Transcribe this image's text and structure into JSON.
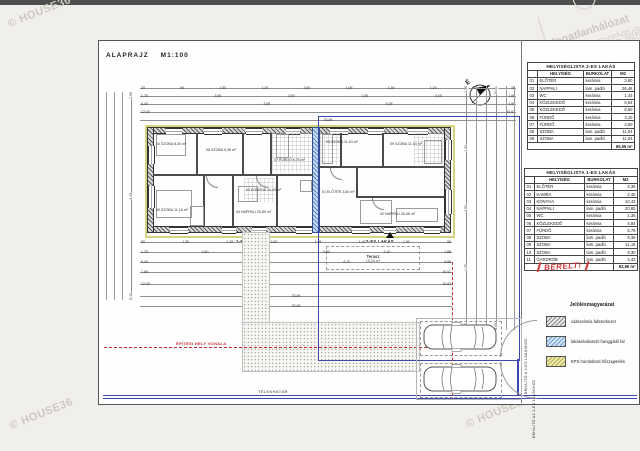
{
  "header": {
    "title": "ALAPRAJZ",
    "scale": "M1:100"
  },
  "compass": {
    "label": "É"
  },
  "watermarks": {
    "copyright": "© HOUSE36"
  },
  "logo": {
    "line1": "Ingatlanhálózat",
    "line2": "HOUSE36"
  },
  "plan": {
    "apartment1_label": "1-ES LAKÁS",
    "apartment2_label": "2-ES LAKÁS",
    "terrace_label": "Terasz",
    "terrace_area": "15,24 m²",
    "building_line_label": "ÉPÍTÉSI HELY VONALA",
    "plot_line_label": "TELEKHATÁR",
    "driveway_label_top": "BEHAJTÓ A 2-ES LAKÁSHOZ",
    "driveway_label_bottom": "BEHAJTÓ AZ 1-ES LAKÁSHOZ",
    "room_tags": [
      "10 SZOBA 8,30 m²",
      "08 SZOBA 9,36 m²",
      "07 FÜRDŐ 5,75 m²",
      "09 SZOBA 11,16 m²",
      "04 NAPPALI 20,80 m²",
      "03 KONYHA 10,43 m²",
      "08 SZOBA 11,04 m²",
      "09 SZOBA 11,04 m²",
      "02 NAPPALI 26,46 m²",
      "01 ELŐTÉR 3,60 m²"
    ],
    "dims": {
      "top": [
        [
          "30",
          "90",
          "1,50",
          "1,20",
          "2,60",
          "1,05",
          "1,50",
          "1,20",
          "90",
          "30"
        ],
        [
          "1,75",
          "3,65",
          "2,60",
          "1,05",
          "3,45",
          "1,88"
        ],
        [
          "5,40",
          "4,65",
          "6,35",
          "4,50"
        ],
        [
          "12,43",
          "10,63"
        ],
        [
          "23,06"
        ]
      ],
      "bottom": [
        [
          "90",
          "1,30",
          "1,20",
          "2,60",
          "1,05",
          "1,40",
          "1,50",
          "90"
        ],
        [
          "1,75",
          "2,60",
          "1,35",
          "4,50",
          "2,10",
          "1,88"
        ],
        [
          "5,43",
          "3,10",
          "4,70",
          "6,88"
        ],
        [
          "7,65",
          "10,01"
        ],
        [
          "12,43",
          "10,63"
        ],
        [
          "23,06"
        ],
        [
          "23,06"
        ]
      ],
      "left": [
        [
          "1,50",
          "4,43",
          "3,10"
        ]
      ],
      "right": [
        [
          "1,50",
          "1,20",
          "4,50",
          "1,05",
          "1,50"
        ],
        [
          "10,01",
          "8,05"
        ]
      ]
    }
  },
  "tables": [
    {
      "title": "HELYISÉGLISTA 2-ES LAKÁS",
      "columns": [
        "HELYISÉG",
        "BURKOLAT",
        "M2"
      ],
      "rows": [
        [
          "01",
          "ELŐTÉR",
          "kerámia",
          "3,60"
        ],
        [
          "02",
          "NAPPALI",
          "lam. padló",
          "26,46"
        ],
        [
          "03",
          "WC",
          "kerámia",
          "1,43"
        ],
        [
          "04",
          "KÖZLEKEDŐ",
          "kerámia",
          "6,64"
        ],
        [
          "05",
          "KÖZLEKEDŐ",
          "kerámia",
          "6,60"
        ],
        [
          "06",
          "FÜRDŐ",
          "kerámia",
          "3,10"
        ],
        [
          "07",
          "FÜRDŐ",
          "kerámia",
          "4,50"
        ],
        [
          "08",
          "SZOBA",
          "lam. padló",
          "11,04"
        ],
        [
          "09",
          "SZOBA",
          "lam. padló",
          "11,04"
        ]
      ],
      "total": "65,55 m²"
    },
    {
      "title": "HELYISÉGLISTA 1-ES LAKÁS",
      "columns": [
        "HELYISÉG",
        "BURKOLAT",
        "M2"
      ],
      "rows": [
        [
          "01",
          "ELŐTÉR",
          "kerámia",
          "4,36"
        ],
        [
          "02",
          "KAMRA",
          "kerámia",
          "2,40"
        ],
        [
          "03",
          "KONYHA",
          "kerámia",
          "10,43"
        ],
        [
          "04",
          "NAPPALI",
          "lam. padló",
          "20,80"
        ],
        [
          "05",
          "WC",
          "kerámia",
          "1,35"
        ],
        [
          "06",
          "KÖZLEKEDŐ",
          "kerámia",
          "4,84"
        ],
        [
          "07",
          "FÜRDŐ",
          "kerámia",
          "5,75"
        ],
        [
          "08",
          "SZOBA",
          "lam. padló",
          "9,36"
        ],
        [
          "09",
          "SZOBA",
          "lam. padló",
          "11,16"
        ],
        [
          "10",
          "SZOBA",
          "lam. padló",
          "8,30"
        ],
        [
          "11",
          "GARDRÓB",
          "lam. padló",
          "4,42"
        ]
      ],
      "total": "82,96 m²",
      "note": "BÉRELT!"
    }
  ],
  "legend": {
    "title": "Jelölésmagyarázat",
    "items": [
      {
        "label": "vázkerámia falszerkezet"
      },
      {
        "label": "lakáselválasztó hanggátló fal"
      },
      {
        "label": "EPS homlokzati hőszigetelés"
      }
    ]
  }
}
